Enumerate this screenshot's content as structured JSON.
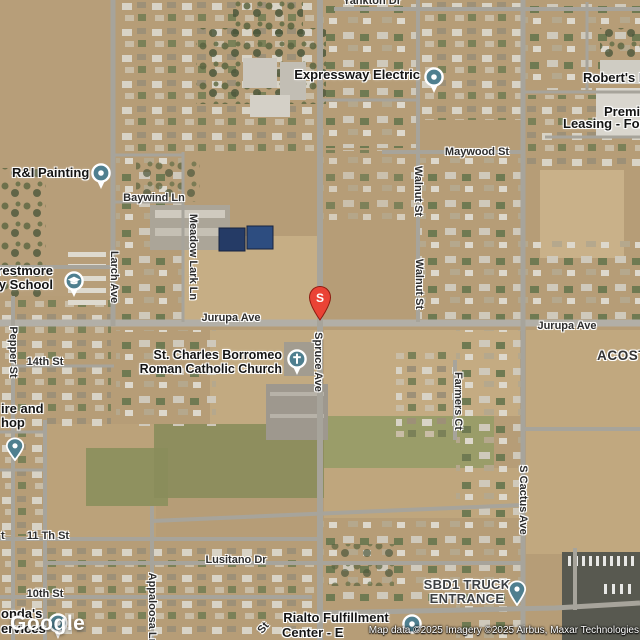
{
  "branding": {
    "logo": "Google",
    "attribution": "Map data ©2025 Imagery ©2025 Airbus, Maxar Technologies"
  },
  "colors": {
    "poi_marker": "#4f7f8f",
    "pin_red": "#ea4335",
    "road": "#a7a49b"
  },
  "pin": {
    "letter": "S"
  },
  "streets": {
    "yankton": "Yankton Dr",
    "jurupa_w": "Jurupa Ave",
    "jurupa_e": "Jurupa Ave",
    "maywood": "Maywood St",
    "walnut_n": "Walnut St",
    "walnut_s": "Walnut St",
    "baywind": "Baywind Ln",
    "larch": "Larch Ave",
    "meadow_lark": "Meadow Lark Ln",
    "pepper": "Pepper St",
    "st14": "14th St",
    "st11": "11 Th St",
    "st10": "10th St",
    "lusitano": "Lusitano Dr",
    "appaloosa": "Appaloosa Ln",
    "farmers": "Farmers Ct",
    "cactus": "S Cactus Ave",
    "acosta": "ACOSTA",
    "frag_st": "St",
    "frag_t": "t"
  },
  "places": {
    "expressway": {
      "name": "Expressway Electric"
    },
    "roberts": {
      "name": "Robert's L"
    },
    "premium": {
      "line1": "Premi",
      "line2": "Leasing - For"
    },
    "r_and_i": {
      "name": "R&I Painting"
    },
    "school": {
      "line1": "restmore",
      "line2": "ry School"
    },
    "church": {
      "line1": "St. Charles Borromeo",
      "line2": "Roman Catholic Church"
    },
    "tire": {
      "line1": "ire and",
      "line2": "hop"
    },
    "services": {
      "line1": "onda's",
      "line2": "ervices"
    },
    "sbd1": {
      "line1": "SBD1 TRUCK",
      "line2": "ENTRANCE"
    },
    "rialto": {
      "line1": "Rialto Fulfillment",
      "line2": "Center - E"
    }
  }
}
